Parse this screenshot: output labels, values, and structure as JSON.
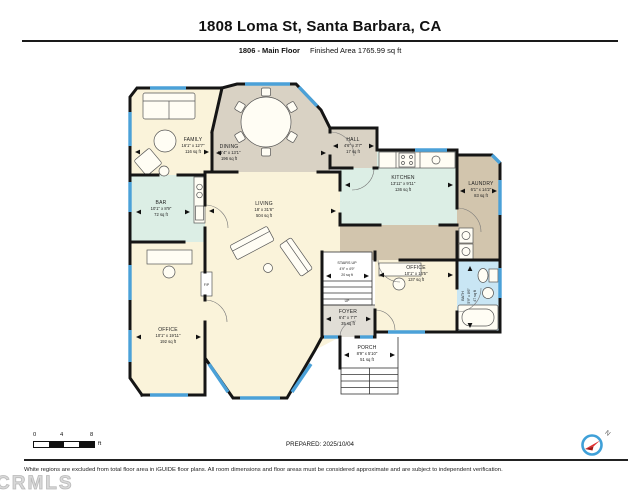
{
  "header": {
    "title": "1808 Loma St, Santa Barbara, CA",
    "floor_label": "1806 - Main Floor",
    "area_label": "Finished Area 1765.99 sq ft"
  },
  "rooms": [
    {
      "id": "family",
      "name": "FAMILY",
      "dims": "16'1\" x 12'7\"",
      "area": "116 sq ft"
    },
    {
      "id": "dining",
      "name": "DINING",
      "dims": "16'4\" x 13'1\"",
      "area": "196 sq ft"
    },
    {
      "id": "hall",
      "name": "HALL",
      "dims": "4'6\" x 3'7\"",
      "area": "17 sq ft"
    },
    {
      "id": "kitchen",
      "name": "KITCHEN",
      "dims": "13'11\" x 9'11\"",
      "area": "136 sq ft"
    },
    {
      "id": "laundry",
      "name": "LAUNDRY",
      "dims": "6'1\" x 14'2\"",
      "area": "83 sq ft"
    },
    {
      "id": "bar",
      "name": "BAR",
      "dims": "10'1\" x 8'9\"",
      "area": "72 sq ft"
    },
    {
      "id": "living",
      "name": "LIVING",
      "dims": "18' x 31'6\"",
      "area": "504 sq ft"
    },
    {
      "id": "stairs",
      "name": "STAIRS UP",
      "dims": "4'9\" x 4'9\"",
      "area": "20 sq ft"
    },
    {
      "id": "office_right",
      "name": "OFFICE",
      "dims": "10'1\" x 14'5\"",
      "area": "137 sq ft"
    },
    {
      "id": "bath",
      "name": "BATH",
      "dims": "5'9\" x 8'6\"",
      "area": "47 sq ft"
    },
    {
      "id": "foyer",
      "name": "FOYER",
      "dims": "6'4\" x 7'7\"",
      "area": "35 sq ft"
    },
    {
      "id": "porch",
      "name": "PORCH",
      "dims": "8'9\" x 5'10\"",
      "area": "51 sq ft"
    },
    {
      "id": "office_left",
      "name": "OFFICE",
      "dims": "10'1\" x 19'11\"",
      "area": "192 sq ft"
    }
  ],
  "annotations": {
    "up": "UP",
    "fireplace": "F/P"
  },
  "footer": {
    "scale_ticks": [
      "0",
      "4",
      "8"
    ],
    "scale_unit": "ft",
    "prepared": "PREPARED: 2025/10/04",
    "disclaimer": "White regions are excluded from total floor area in iGUIDE floor plans. All room dimensions and floor areas must be considered approximate and are subject to independent verification.",
    "watermark": "CRMLS",
    "compass_label": "N"
  },
  "colors": {
    "wall": "#151515",
    "window": "#4ba1d8",
    "cream": "#faf3da",
    "dining_tan": "#d9d2c4",
    "corridor_tan": "#d2c5ad",
    "teal": "#dceee5",
    "bath_blue": "#c9e6f4",
    "foyer_gray": "#e1ded6"
  }
}
